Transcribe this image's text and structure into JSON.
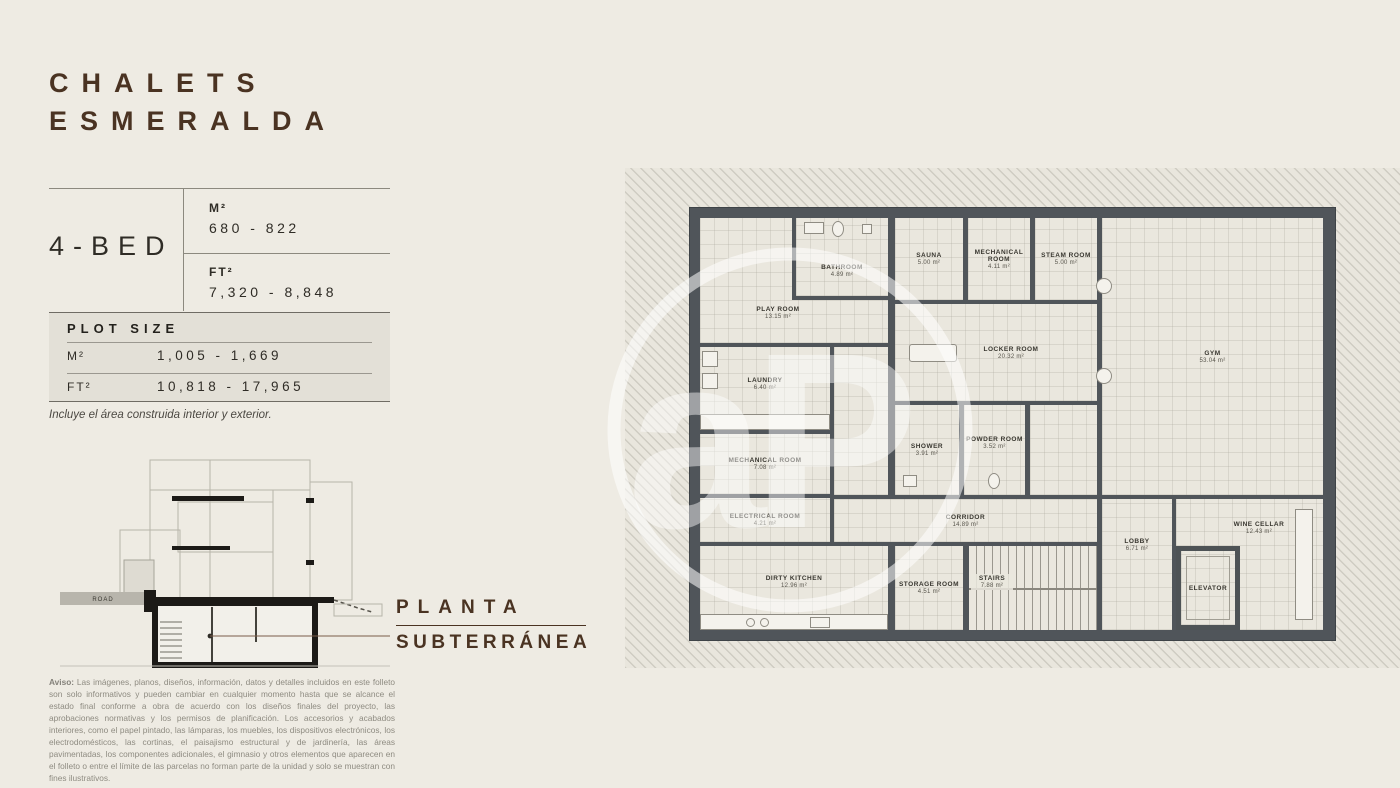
{
  "brand": {
    "title_line1": "CHALETS",
    "title_line2": "ESMERALDA",
    "watermark_letters": "aP"
  },
  "unit_table": {
    "bed_label": "4-BED",
    "m2_label": "M²",
    "m2_value": "680 - 822",
    "ft2_label": "FT²",
    "ft2_value": "7,320 - 8,848"
  },
  "plot_size": {
    "header": "PLOT SIZE",
    "rows": [
      {
        "label": "M²",
        "value": "1,005 - 1,669"
      },
      {
        "label": "FT²",
        "value": "10,818 - 17,965"
      }
    ],
    "note": "Incluye el área construida interior y exterior."
  },
  "section": {
    "road_label": "ROAD"
  },
  "floor_label": {
    "line1": "PLANTA",
    "line2": "SUBTERRÁNEA"
  },
  "disclaimer": {
    "prefix": "Aviso:",
    "text": "Las imágenes, planos, diseños, información, datos y detalles incluidos en este folleto son solo informativos y pueden cambiar en cualquier momento hasta que se alcance el estado final conforme a obra de acuerdo con los diseños finales del proyecto, las aprobaciones normativas y los permisos de planificación. Los accesorios y acabados interiores, como el papel pintado, las lámparas, los muebles, los dispositivos electrónicos, los electrodomésticos, las cortinas, el paisajismo estructural y de jardinería, las áreas pavimentadas, los componentes adicionales, el gimnasio y otros elementos que aparecen en el folleto o entre el límite de las parcelas no forman parte de la unidad y solo se muestran con fines ilustrativos."
  },
  "floor_plan": {
    "rooms": [
      {
        "name": "PLAY ROOM",
        "area": "13.15 m²"
      },
      {
        "name": "BATHROOM",
        "area": "4.89 m²"
      },
      {
        "name": "SAUNA",
        "area": "5.00 m²"
      },
      {
        "name": "MECHANICAL ROOM",
        "area": "4.11 m²"
      },
      {
        "name": "STEAM ROOM",
        "area": "5.00 m²"
      },
      {
        "name": "GYM",
        "area": "53.04 m²"
      },
      {
        "name": "LOCKER ROOM",
        "area": "20.32 m²"
      },
      {
        "name": "LAUNDRY",
        "area": "6.40 m²"
      },
      {
        "name": "MECHANICAL ROOM",
        "area": "7.08 m²"
      },
      {
        "name": "SHOWER",
        "area": "3.91 m²"
      },
      {
        "name": "POWDER ROOM",
        "area": "3.52 m²"
      },
      {
        "name": "ELECTRICAL ROOM",
        "area": "4.21 m²"
      },
      {
        "name": "CORRIDOR",
        "area": "14.89 m²"
      },
      {
        "name": "DIRTY KITCHEN",
        "area": "12.96 m²"
      },
      {
        "name": "STORAGE ROOM",
        "area": "4.51 m²"
      },
      {
        "name": "STAIRS",
        "area": "7.88 m²"
      },
      {
        "name": "LOBBY",
        "area": "6.71 m²"
      },
      {
        "name": "WINE CELLAR",
        "area": "12.43 m²"
      },
      {
        "name": "ELEVATOR",
        "area": ""
      }
    ]
  },
  "colors": {
    "background": "#eeebe3",
    "brand_brown": "#4a3322",
    "wall_gray": "#50555a",
    "plot_box_bg": "#e3e0d7",
    "room_floor": "#eae7de"
  }
}
